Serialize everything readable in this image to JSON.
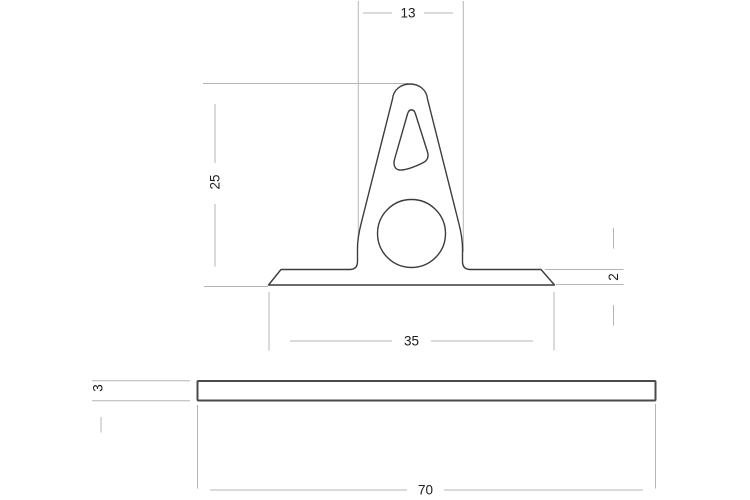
{
  "drawing": {
    "type": "technical-cross-section",
    "background_color": "#ffffff",
    "outline_color": "#3c3c3c",
    "plate_outline_color": "#4a4a4a",
    "dimension_line_color": "#b4b4b4",
    "dimension_text_color": "#1c1c1c",
    "profile": {
      "dim_stem_width": "13",
      "dim_height": "25",
      "dim_flange_thickness": "2",
      "dim_flange_width": "35"
    },
    "plate": {
      "dim_thickness": "3",
      "dim_width": "70"
    }
  }
}
